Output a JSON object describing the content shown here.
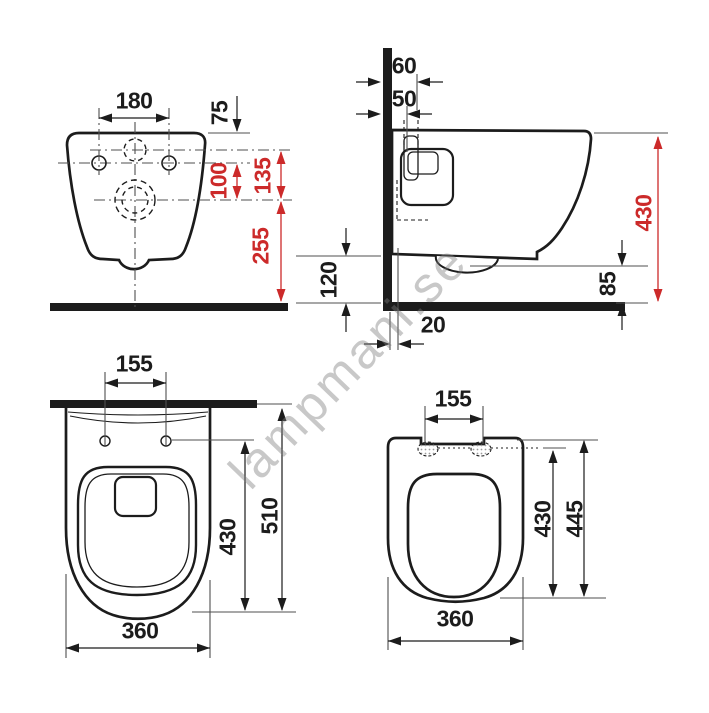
{
  "title": "Wall-hung toilet technical dimension drawing",
  "watermark": {
    "text": "lampmani.se"
  },
  "colors": {
    "line_black": "#1c1c1c",
    "dimension_red": "#cc2a2a",
    "reference_gray": "#4f4f4f",
    "watermark_gray": "#7d7d7d"
  },
  "views": {
    "front": {
      "label": "front view",
      "dims": {
        "hole_spacing": "180",
        "top_to_holes": "75",
        "holes_to_outlet": "100",
        "inlet_to_outlet": "135",
        "outlet_to_floor": "255"
      }
    },
    "side": {
      "label": "side view",
      "dims": {
        "flush_depth": "60",
        "inlet_depth": "50",
        "height": "430",
        "underside_to_floor": "120",
        "outlet_height": "85",
        "wall_gap": "20"
      }
    },
    "plan": {
      "label": "bowl plan view",
      "dims": {
        "hinge_spacing": "155",
        "hinge_to_front": "430",
        "depth": "510",
        "width": "360"
      }
    },
    "seat": {
      "label": "seat plan view",
      "dims": {
        "hinge_spacing": "155",
        "hinge_to_front": "430",
        "length": "445",
        "width": "360"
      }
    }
  }
}
